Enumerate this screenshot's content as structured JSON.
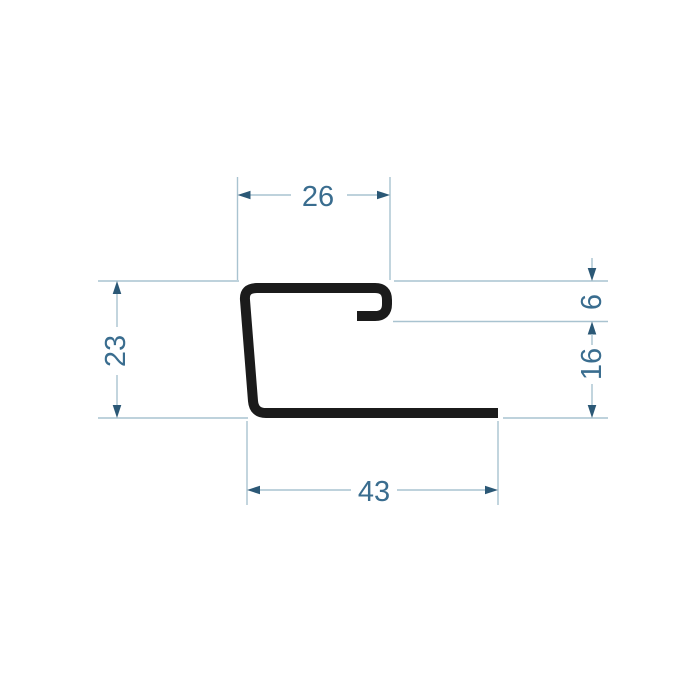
{
  "drawing": {
    "type": "technical-profile-cross-section",
    "dimensions": {
      "top_width": "26",
      "hook_depth": "6",
      "right_height": "16",
      "left_height": "23",
      "bottom_width": "43"
    },
    "colors": {
      "background": "#ffffff",
      "profile_outline": "#1b1b1b",
      "dimension_lines": "#a9c3d0",
      "arrowheads": "#2b5876",
      "dimension_text": "#3a6d8f"
    }
  }
}
